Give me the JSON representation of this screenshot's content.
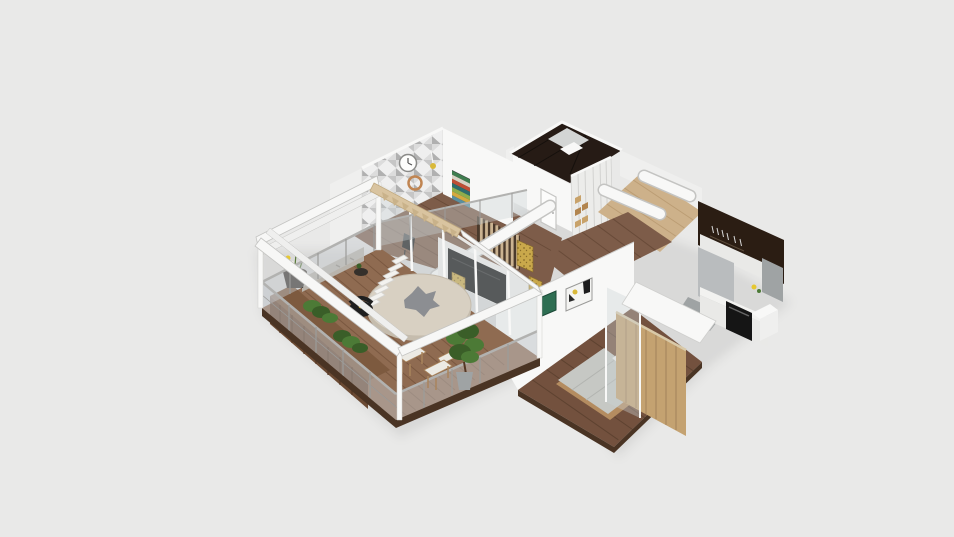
{
  "meta": {
    "kind": "3d-isometric-floorplan-render",
    "description": "Bird's-eye cutaway 3D render of an apartment on a plain light gray background; no UI chrome, toolbars or text are visible.",
    "visible_text": [],
    "camera": "elevated three-quarter view from the south-east"
  },
  "scene": {
    "rooms": [
      {
        "name": "terrace",
        "floor": "warm wood decking",
        "features": [
          "white pergola beam frame",
          "glass balustrade with metal posts",
          "dark wood planter sideboard with greenery",
          "flower pot with yellow flowers",
          "round cream parasol over dining spot",
          "white stepped lounger",
          "black outdoor armchair",
          "two wood chairs with white cushions",
          "tall potted plant"
        ]
      },
      {
        "name": "living-dining room",
        "floor": "wood planks",
        "features": [
          "geometric gray triangle accent wall",
          "white wall clock",
          "copper wall clock",
          "colorful striped wall art",
          "black TV media wall",
          "gold textured art panels",
          "vertical wood slat partition",
          "black bar stool",
          "glass sliding wall to terrace",
          "wood rafter beam with brackets"
        ]
      },
      {
        "name": "bathroom",
        "floor": "dark tile",
        "features": [
          "dark brown glossy tiled walls",
          "white fixtures"
        ]
      },
      {
        "name": "closet hall",
        "floor": "wood planks",
        "features": [
          "white wardrobe with open shelves and tan boxes",
          "white interior door"
        ]
      },
      {
        "name": "study nook",
        "floor": "light wood",
        "features": [
          "small desk",
          "white chair",
          "yellow desk lamp",
          "rounded white ceiling bulkheads"
        ]
      },
      {
        "name": "kitchen",
        "floor": "gray",
        "features": [
          "dark brown accent wall with hanging utensils",
          "white upper cabinets",
          "gray tall unit",
          "black built-in oven",
          "white countertop with small items"
        ]
      },
      {
        "name": "bedroom",
        "floor": "dark wood planks",
        "features": [
          "platform bed with gray duvet",
          "white pillows",
          "orange throw blanket",
          "light wood panel partition wall",
          "glass divider panel",
          "green framed artwork",
          "black-and-gold framed artwork",
          "white soffit"
        ]
      }
    ]
  },
  "palette": {
    "bg": "#e9e9e8",
    "shadow": "rgba(0,0,0,0.07)",
    "wallA": "#f8f8f7",
    "wallB": "#efefee",
    "wallC": "#e4e4e2",
    "wallStroke": "#cfcfcd",
    "beam": "#f7f7f6",
    "beamStroke": "#c4c4c2",
    "deck": "#8f6b51",
    "deckPlank": "#7a5840",
    "wood": "#7d5c49",
    "woodPlank": "#694b39",
    "bedFloor": "#73513e",
    "bedFloorPlank": "#5e4230",
    "lightWood": "#cdb18a",
    "lightWoodPlank": "#bb9d74",
    "bathDark": "#261b15",
    "bathLight": "#d3d5d4",
    "kitchenDark": "#2b1d13",
    "cabinet": "#e9e9e7",
    "counter": "#f2f2f0",
    "grayUnit": "#b9bcbe",
    "graySide": "#9fa3a4",
    "oven": "#151515",
    "slatBase": "#4a3a2c",
    "slat": "#cbb391",
    "tv": "#111111",
    "tvWall": "#f0efed",
    "gold": "#c9a84b",
    "goldDark": "#8a6d2a",
    "glass": "rgba(203,210,214,0.38)",
    "glassRail": "rgba(199,205,209,0.45)",
    "rail": "#b2b2b0",
    "post": "#9c9c9a",
    "planter": "#6b4a33",
    "planterTop": "#7d5a3f",
    "planterLine": "#543724",
    "green": "#4c7a36",
    "greenDark": "#3a5e28",
    "stem": "#5a7a3a",
    "flowerYellow": "#e6c832",
    "flowerWhite": "#f2f0e6",
    "potDark": "#35302b",
    "stone": "#b9b4ac",
    "stoneDot": "#8f8a82",
    "fascia": "#4a3424",
    "parasol": "#d8d0c2",
    "parasolEdge": "#c5bcad",
    "parasolTop": "#8c8e92",
    "stepWhite": "#f3f2ef",
    "stepStroke": "#d5d4d1",
    "black": "#1f1f1f",
    "yellow": "#d9b93a",
    "cushion": "#eceae4",
    "chairWood": "#a9845c",
    "duvet": "#c6c8c4",
    "duvetLine": "#b2b4b0",
    "pillow": "#efefed",
    "orange": "#dd6a1f",
    "bedBase": "#b48c60",
    "wardrobe": "#c4a271",
    "wardrobeLine": "#a2815a",
    "closet": "#ececea",
    "closetLine": "#d2d2d0",
    "itemTan": "#c8a26a",
    "itemTan2": "#b2854f",
    "artGreen": "#2e6e52",
    "artGreenDark": "#1d4a38",
    "artFrame": "#f4f4f2",
    "artStroke": "#9a9a98",
    "doorWhite": "#fcfcfb",
    "doorStroke": "#c6c6c4",
    "clockFace": "#fdfdfc",
    "clockStroke": "#8a8a88",
    "copper": "#c08552",
    "rafter": "#d9c4a0",
    "rafterTooth": "#c9b28a",
    "rafterStroke": "#bfa87e",
    "accentA": "#ffffff",
    "accentB": "#dcdcdc",
    "accentC": "#c6c6c6",
    "accentD": "#b0b0b0",
    "stripe1": "#3f7d4f",
    "stripe2": "#d8d2c4",
    "stripe3": "#bf4f35",
    "stripe4": "#2e6d6d",
    "stripe5": "#8fae4c",
    "stripe6": "#d4a93f",
    "stripe7": "#5a8f9f",
    "utensil": "#d8d8d8"
  }
}
